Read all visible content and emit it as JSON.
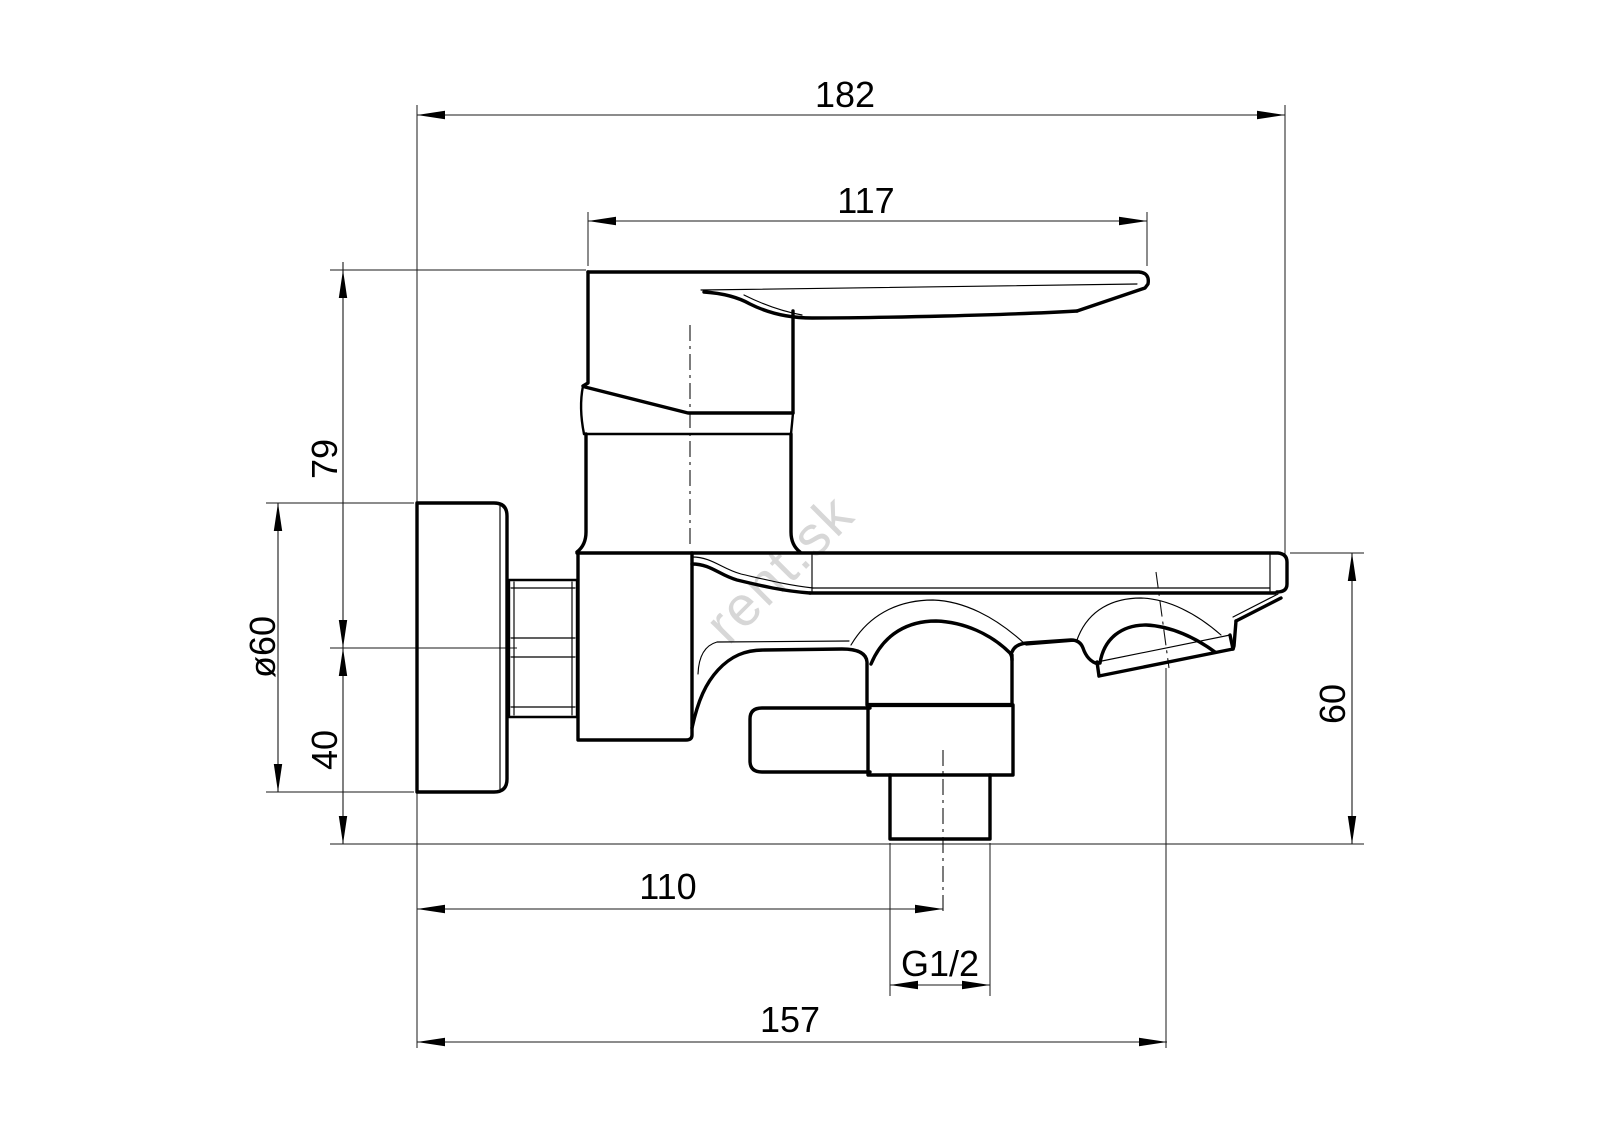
{
  "drawing": {
    "type": "technical-dimension-drawing",
    "subject": "wall-mounted bath mixer tap, side view",
    "watermark": "rent.sk",
    "background_color": "#ffffff",
    "line_color": "#000000",
    "watermark_color": "#d7d7d7",
    "labels": {
      "total_depth": "182",
      "handle_length": "117",
      "upper_height": "79",
      "flange_diameter": "ø60",
      "lower_height": "40",
      "spout_height": "60",
      "outlet_offset": "110",
      "thread_size": "G1/2",
      "spout_reach": "157"
    }
  }
}
